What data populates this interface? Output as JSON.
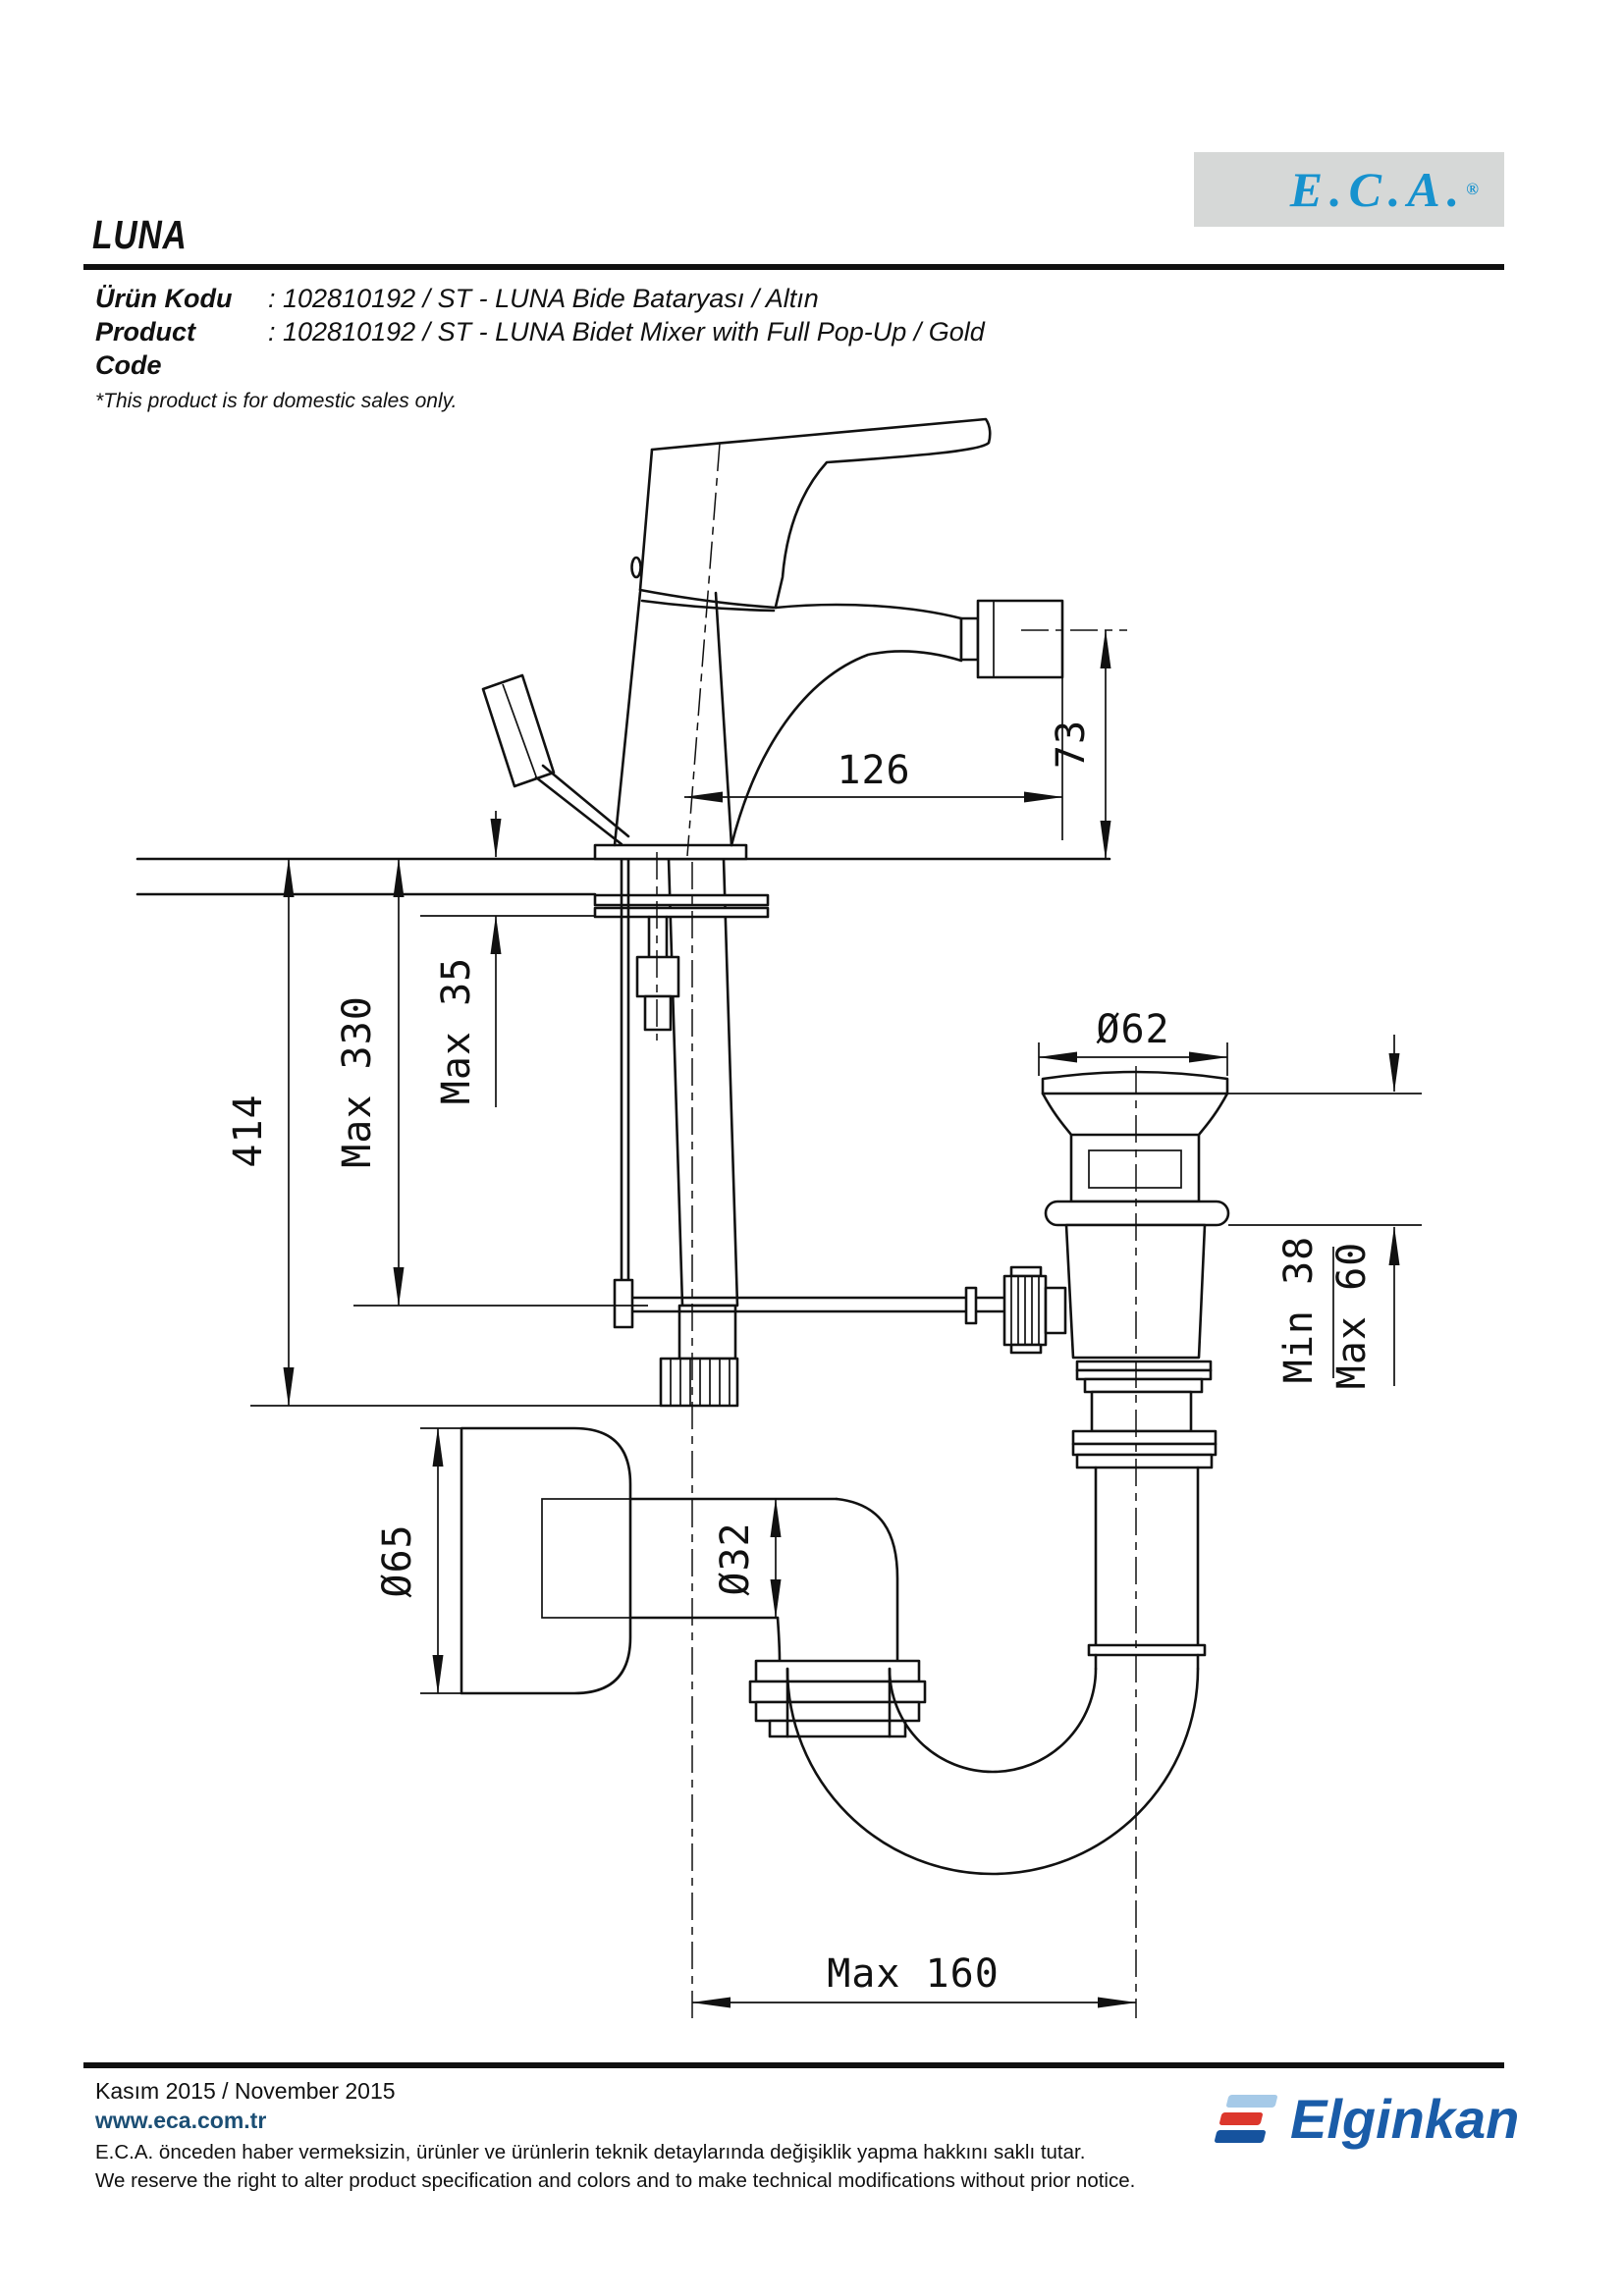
{
  "header": {
    "series_title": "LUNA",
    "brand_logo": {
      "text": "E.C.A.",
      "registered_mark": "®"
    }
  },
  "product_info": {
    "rows": [
      {
        "label": "Ürün Kodu",
        "value": ": 102810192 / ST - LUNA Bide Bataryası / Altın"
      },
      {
        "label": "Product Code",
        "value": ": 102810192 / ST - LUNA Bidet Mixer with Full Pop-Up / Gold"
      }
    ],
    "note": "*This product is for domestic sales only."
  },
  "drawing": {
    "type": "technical-drawing",
    "subject": "LUNA bidet mixer with pop-up waste and siphon - installation dimensions (mm)",
    "dimensions": {
      "spout_reach": "126",
      "spout_height": "73",
      "overall_height": "414",
      "hose_length_max": "Max 330",
      "deck_thickness_max": "Max 35",
      "popup_cap_diameter": "Ø62",
      "popup_deck_min": "Min 38",
      "popup_deck_max": "Max 60",
      "wall_flange_diameter": "Ø65",
      "trap_pipe_diameter": "Ø32",
      "trap_horizontal_max": "Max 160"
    }
  },
  "footer": {
    "date": "Kasım 2015 / November 2015",
    "website": "www.eca.com.tr",
    "disclaimer_tr": "E.C.A. önceden haber vermeksizin, ürünler ve ürünlerin teknik detaylarında değişiklik yapma hakkını saklı tutar.",
    "disclaimer_en": "We reserve the right to alter product specification and colors and to make technical modifications without prior notice.",
    "company_logo_text": "Elginkan"
  },
  "colors": {
    "eca_blue": "#1792ce",
    "logo_box_gray": "#d6d8d7",
    "website_navy": "#1b4e74",
    "elginkan_blue": "#1a5ca8",
    "elginkan_red": "#dc372c",
    "elginkan_light_blue": "#a6cae8",
    "line_black": "#111111"
  }
}
